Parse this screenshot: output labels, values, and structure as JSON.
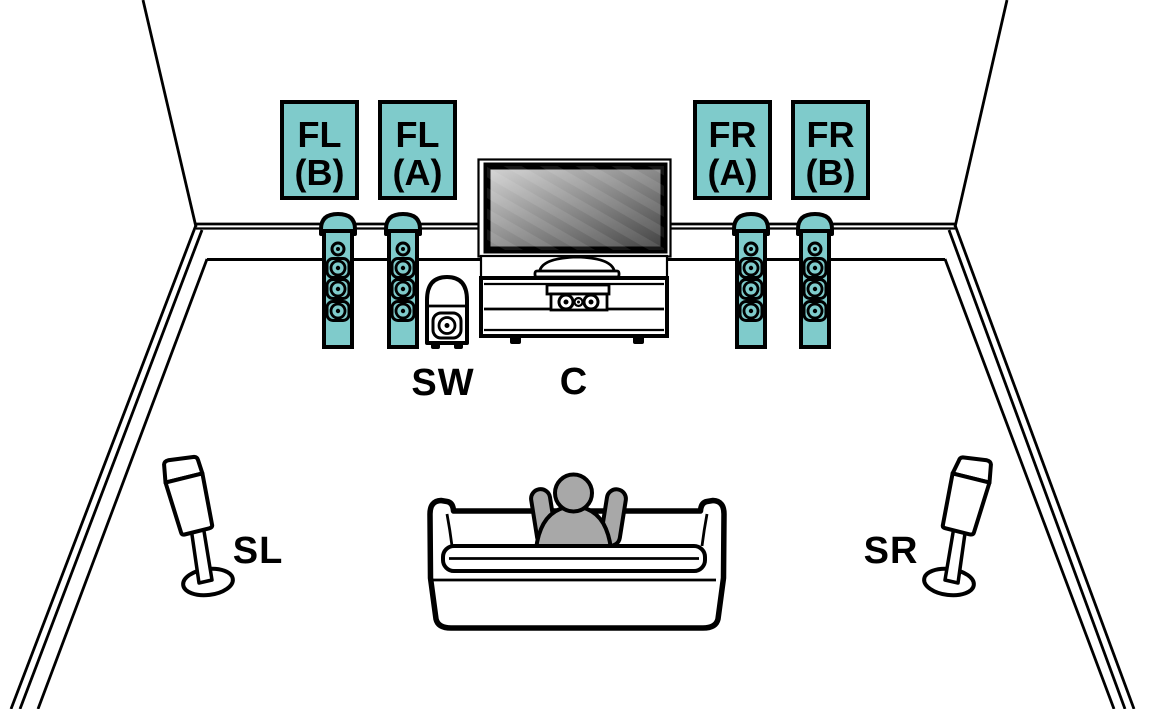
{
  "diagram": {
    "type": "home-theater-speaker-layout",
    "front_labels": [
      {
        "id": "fl-b",
        "line1": "FL",
        "line2": "(B)"
      },
      {
        "id": "fl-a",
        "line1": "FL",
        "line2": "(A)"
      },
      {
        "id": "fr-a",
        "line1": "FR",
        "line2": "(A)"
      },
      {
        "id": "fr-b",
        "line1": "FR",
        "line2": "(B)"
      }
    ],
    "floor_labels": {
      "subwoofer": "SW",
      "center": "C",
      "surround_left": "SL",
      "surround_right": "SR"
    }
  },
  "colors": {
    "speaker_teal": "#7fcbcb",
    "outline": "#000000",
    "person_gray": "#a8a8a8",
    "background": "#ffffff",
    "screen_light": "#d6d6d6",
    "screen_dark": "#404040"
  }
}
